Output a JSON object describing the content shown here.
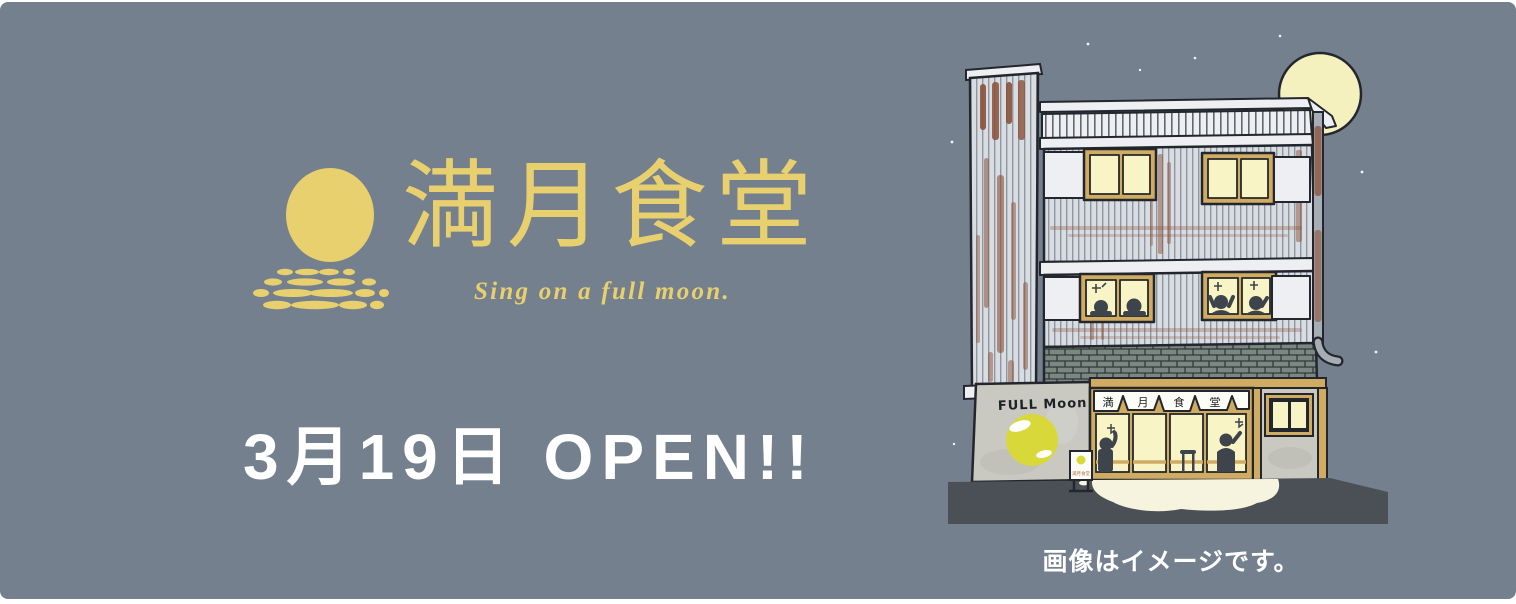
{
  "colors": {
    "bg": "#75808E",
    "gold": "#E8D06E",
    "white": "#FFFFFF",
    "outline": "#23272D",
    "panel": "#EDEFF2",
    "wall": "#D8DDE3",
    "wall_line": "#4A5058",
    "rust": "#8A5138",
    "glow": "#F8F4C6",
    "tan": "#D0AC62",
    "brick": "#7B8881",
    "brick_line": "#31373B",
    "concrete": "#C9C9C2",
    "sign_yellow": "#D9D83B",
    "ground": "#4B5056",
    "pool": "#F6F3DF",
    "silhouette": "#3E444B",
    "noren": "#FDFDF8",
    "moon_pale": "#F5F1BE",
    "pipe": "#A7ADB4"
  },
  "logo": {
    "title": "満月食堂",
    "tagline": "Sing on a full moon.",
    "icon": "full-moon-over-water-reflection"
  },
  "announcement": {
    "text": "3月19日 OPEN!!"
  },
  "illustration": {
    "subject": "three-story-restaurant-building-at-night",
    "wall_sign": "FULL Moon",
    "noren_chars": [
      "満",
      "月",
      "食",
      "堂"
    ],
    "board_sign": "満月食堂"
  },
  "caption": {
    "text": "画像はイメージです。"
  }
}
